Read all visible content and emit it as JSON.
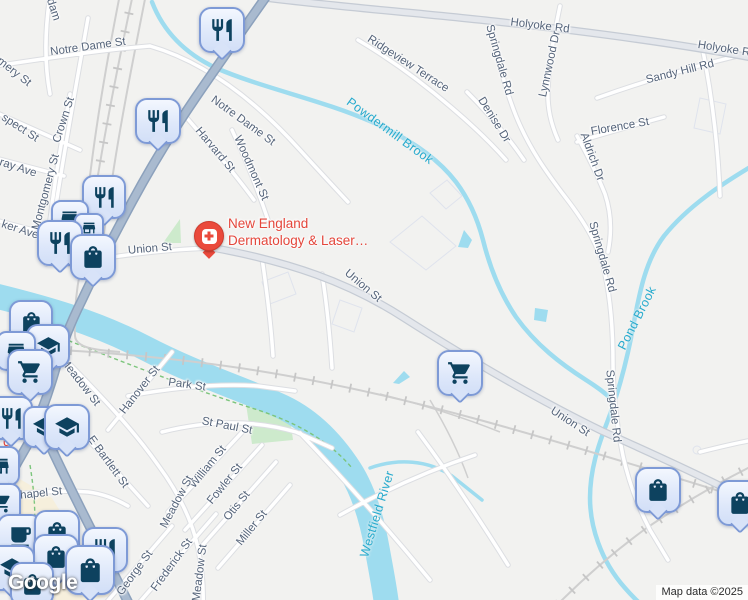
{
  "map": {
    "logo": "Google",
    "attribution": "Map data ©2025",
    "background": "#f2f2f0"
  },
  "poi": {
    "name_line1": "New England",
    "name_line2": "Dermatology & Laser…",
    "icon": "hospital-cross",
    "color": "#ea4a3c"
  },
  "poi_fragment": {
    "text": "d",
    "x": 3,
    "y": 434
  },
  "colors": {
    "water": "#9edcef",
    "water_label": "#27abce",
    "street_label": "#55647a",
    "pin_background": "#dde7fa",
    "pin_border": "#7e9ad6",
    "pin_icon": "#0d425f",
    "slate_road": "#a9bacf",
    "poi_red": "#ea4a3c",
    "park_green": "#cdeacc"
  },
  "street_labels": [
    {
      "t": "Adam",
      "x": 52,
      "y": 6,
      "r": 72
    },
    {
      "t": "Notre Dame St",
      "x": 88,
      "y": 47,
      "r": -8
    },
    {
      "t": "Notre Dame St",
      "x": 243,
      "y": 121,
      "r": 36
    },
    {
      "t": "mery St",
      "x": 14,
      "y": 72,
      "r": 38
    },
    {
      "t": "Crown St",
      "x": 64,
      "y": 120,
      "r": -72
    },
    {
      "t": "Montgomery St",
      "x": 46,
      "y": 192,
      "r": -75
    },
    {
      "t": "spect St",
      "x": 20,
      "y": 128,
      "r": 33
    },
    {
      "t": "ray Ave",
      "x": 18,
      "y": 168,
      "r": 18
    },
    {
      "t": "ker Ave",
      "x": 20,
      "y": 230,
      "r": 18
    },
    {
      "t": "Harvard St",
      "x": 215,
      "y": 150,
      "r": 50
    },
    {
      "t": "Woodmont St",
      "x": 251,
      "y": 168,
      "r": 66
    },
    {
      "t": "Union St",
      "x": 150,
      "y": 249,
      "r": -5
    },
    {
      "t": "Union St",
      "x": 363,
      "y": 286,
      "r": 40
    },
    {
      "t": "Union St",
      "x": 570,
      "y": 422,
      "r": 33
    },
    {
      "t": "Holyoke Rd",
      "x": 540,
      "y": 26,
      "r": 7
    },
    {
      "t": "Holyoke R",
      "x": 724,
      "y": 49,
      "r": 9
    },
    {
      "t": "Ridgeview Terrace",
      "x": 408,
      "y": 64,
      "r": 33
    },
    {
      "t": "Springdale Rd",
      "x": 499,
      "y": 60,
      "r": 74
    },
    {
      "t": "Lynnwood Dr",
      "x": 550,
      "y": 64,
      "r": -78
    },
    {
      "t": "Denise Dr",
      "x": 494,
      "y": 120,
      "r": 58
    },
    {
      "t": "Sandy Hill Rd",
      "x": 680,
      "y": 72,
      "r": -14
    },
    {
      "t": "Florence St",
      "x": 620,
      "y": 127,
      "r": -10
    },
    {
      "t": "Aldrich Dr",
      "x": 592,
      "y": 157,
      "r": 70
    },
    {
      "t": "Springdale Rd",
      "x": 602,
      "y": 257,
      "r": 74
    },
    {
      "t": "Springdale Rd",
      "x": 613,
      "y": 406,
      "r": 84
    },
    {
      "t": "Meadow St",
      "x": 80,
      "y": 382,
      "r": 52
    },
    {
      "t": "Hanover St",
      "x": 140,
      "y": 390,
      "r": -52
    },
    {
      "t": "Park St",
      "x": 187,
      "y": 385,
      "r": 8
    },
    {
      "t": "St Paul St",
      "x": 227,
      "y": 426,
      "r": 11
    },
    {
      "t": "E Bartlett St",
      "x": 108,
      "y": 462,
      "r": 54
    },
    {
      "t": "William St",
      "x": 208,
      "y": 467,
      "r": -51
    },
    {
      "t": "Fowler St",
      "x": 225,
      "y": 484,
      "r": -51
    },
    {
      "t": "Otis St",
      "x": 237,
      "y": 506,
      "r": -51
    },
    {
      "t": "Miller St",
      "x": 252,
      "y": 528,
      "r": -51
    },
    {
      "t": "Meadow St",
      "x": 177,
      "y": 502,
      "r": -62
    },
    {
      "t": "Meadow St",
      "x": 200,
      "y": 573,
      "r": -83
    },
    {
      "t": "Frederick St",
      "x": 172,
      "y": 565,
      "r": -54
    },
    {
      "t": "George St",
      "x": 135,
      "y": 573,
      "r": -54
    },
    {
      "t": "Chapel St",
      "x": 37,
      "y": 494,
      "r": -6
    }
  ],
  "water_labels": [
    {
      "t": "Powdermill Brook",
      "x": 390,
      "y": 131,
      "r": 36
    },
    {
      "t": "Pond Brook",
      "x": 637,
      "y": 318,
      "r": -63
    },
    {
      "t": "Westfield River",
      "x": 377,
      "y": 514,
      "r": -73
    }
  ],
  "pins": [
    {
      "i": "restaurant",
      "x": 222,
      "y": 30,
      "s": 46
    },
    {
      "i": "restaurant",
      "x": 158,
      "y": 121,
      "s": 46
    },
    {
      "i": "restaurant",
      "x": 104,
      "y": 197,
      "s": 44
    },
    {
      "i": "store",
      "x": 70,
      "y": 219,
      "s": 38
    },
    {
      "i": "store",
      "x": 89,
      "y": 228,
      "s": 30
    },
    {
      "i": "restaurant",
      "x": 60,
      "y": 243,
      "s": 46
    },
    {
      "i": "bag",
      "x": 93,
      "y": 257,
      "s": 46
    },
    {
      "i": "bag",
      "x": 31,
      "y": 322,
      "s": 44
    },
    {
      "i": "grad",
      "x": 48,
      "y": 346,
      "s": 44
    },
    {
      "i": "store",
      "x": 16,
      "y": 351,
      "s": 40
    },
    {
      "i": "cart",
      "x": 30,
      "y": 372,
      "s": 46
    },
    {
      "i": "restaurant",
      "x": 11,
      "y": 418,
      "s": 44
    },
    {
      "i": "grad",
      "x": 44,
      "y": 427,
      "s": 42
    },
    {
      "i": "grad",
      "x": 67,
      "y": 427,
      "s": 46
    },
    {
      "i": "store",
      "x": 0,
      "y": 466,
      "s": 40
    },
    {
      "i": "cart",
      "x": 1,
      "y": 503,
      "s": 40
    },
    {
      "i": "coffee",
      "x": 20,
      "y": 537,
      "s": 46
    },
    {
      "i": "bag",
      "x": 57,
      "y": 533,
      "s": 46
    },
    {
      "i": "bag",
      "x": 56,
      "y": 557,
      "s": 46
    },
    {
      "i": "grad",
      "x": 12,
      "y": 568,
      "s": 46
    },
    {
      "i": "restaurant",
      "x": 105,
      "y": 550,
      "s": 46
    },
    {
      "i": "bag",
      "x": 90,
      "y": 570,
      "s": 50
    },
    {
      "i": "bag",
      "x": 32,
      "y": 584,
      "s": 44
    },
    {
      "i": "cart",
      "x": 460,
      "y": 373,
      "s": 46
    },
    {
      "i": "bag",
      "x": 658,
      "y": 490,
      "s": 46
    },
    {
      "i": "bag",
      "x": 740,
      "y": 503,
      "s": 46
    }
  ]
}
